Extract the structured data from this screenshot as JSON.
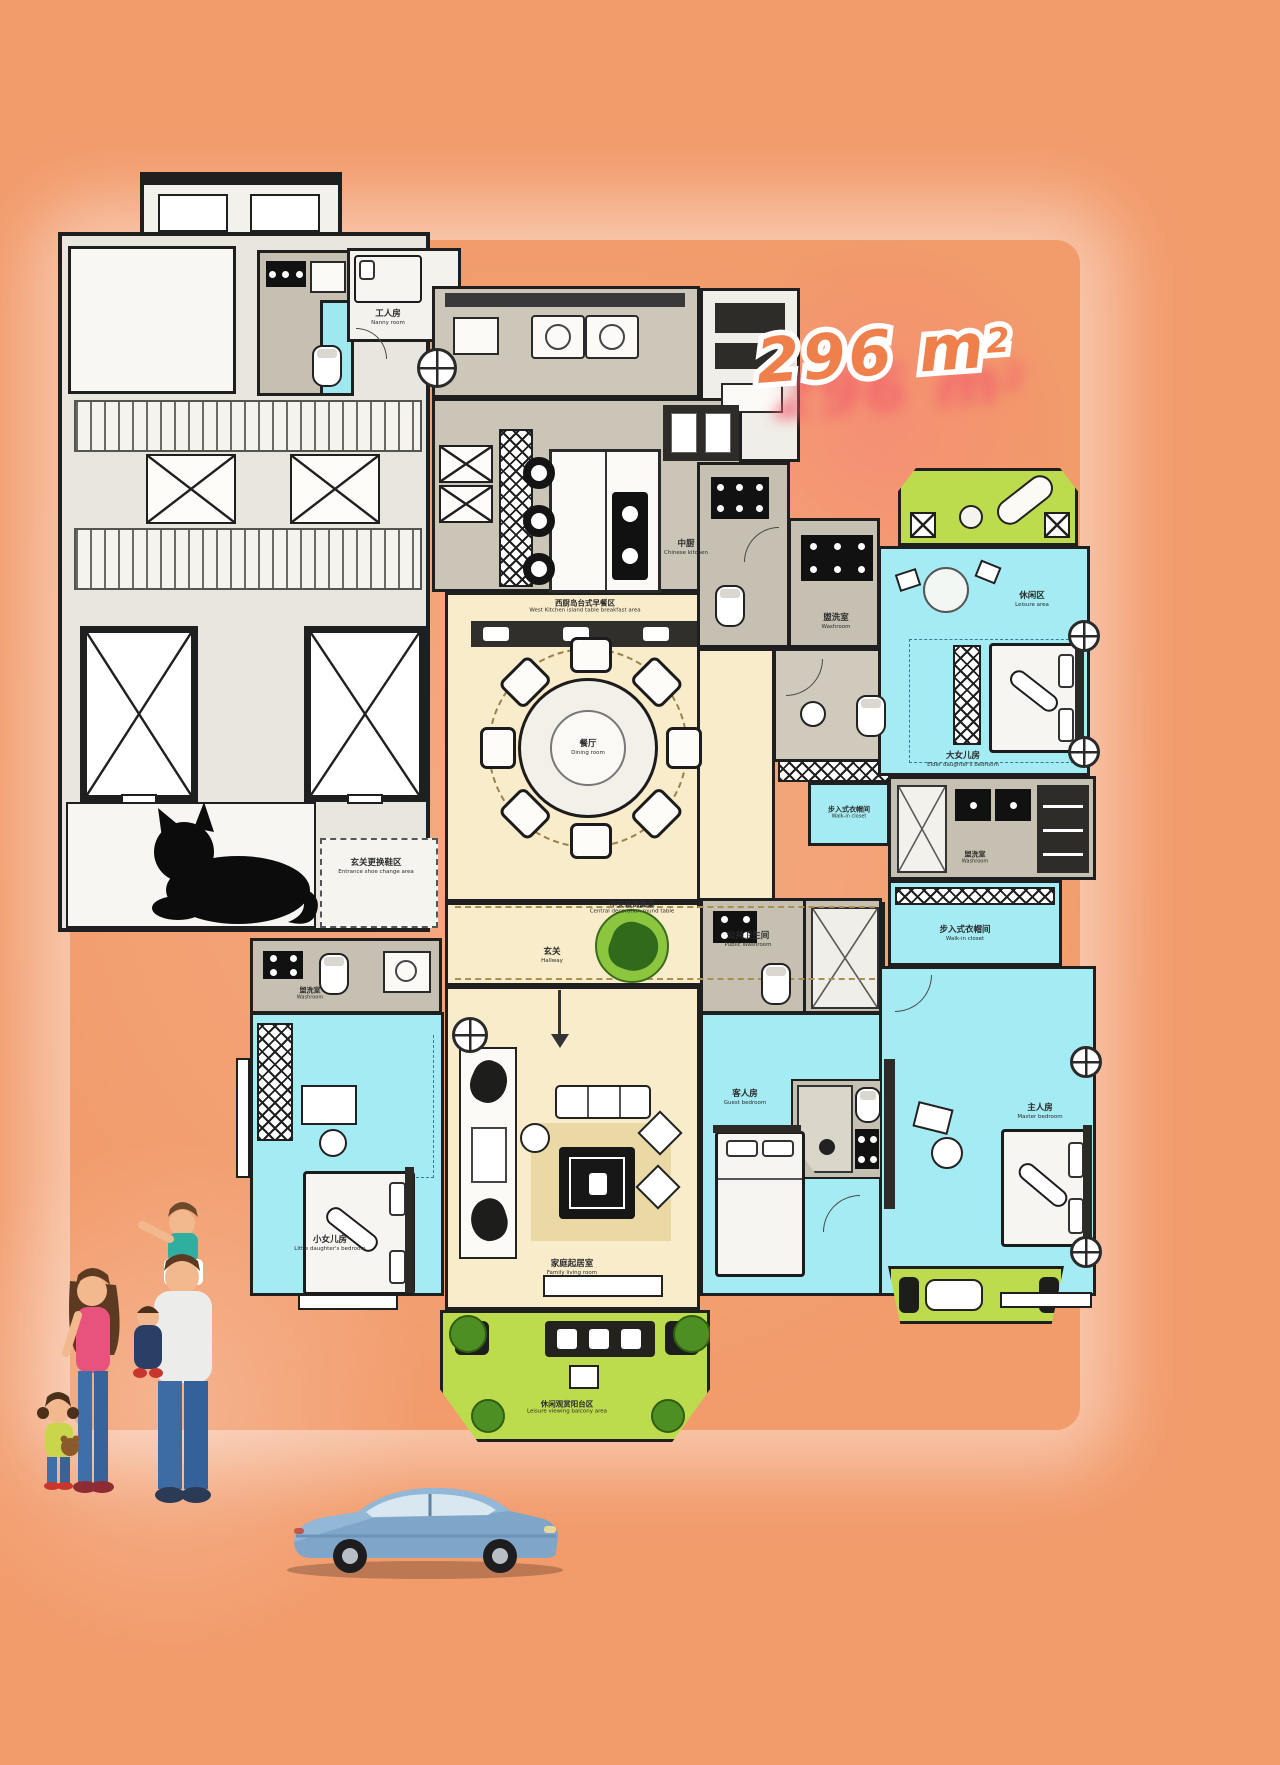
{
  "area_badge": {
    "value": "296 m",
    "superscript": "2"
  },
  "rooms": {
    "nanny_room": {
      "zh": "工人房",
      "en": "Nanny room"
    },
    "chinese_kitchen": {
      "zh": "中厨",
      "en": "Chinese kitchen"
    },
    "breakfast_area": {
      "zh": "西厨岛台式早餐区",
      "en": "West Kitchen island table breakfast area"
    },
    "dining_room": {
      "zh": "餐厅",
      "en": "Dining room"
    },
    "central_table": {
      "zh": "中央装饰圆桌",
      "en": "Central decoration round table"
    },
    "hallway": {
      "zh": "玄关",
      "en": "Hallway"
    },
    "entrance_shoe_area": {
      "zh": "玄关更换鞋区",
      "en": "Entrance shoe change area"
    },
    "leisure_area": {
      "zh": "休闲区",
      "en": "Leisure area"
    },
    "elder_daughter_bedroom": {
      "zh": "大女儿房",
      "en": "Elder daughter's bedroom"
    },
    "washroom_top": {
      "zh": "盥洗室",
      "en": "Washroom"
    },
    "washroom_master": {
      "zh": "盥洗室",
      "en": "Washroom"
    },
    "washroom_little": {
      "zh": "盥洗室",
      "en": "Washroom"
    },
    "public_washroom": {
      "zh": "公共卫生间",
      "en": "Public Washroom"
    },
    "walk_in_closet_1": {
      "zh": "步入式衣帽间",
      "en": "Walk-in closet"
    },
    "walk_in_closet_2": {
      "zh": "步入式衣帽间",
      "en": "Walk-in closet"
    },
    "master_bedroom": {
      "zh": "主人房",
      "en": "Master bedroom"
    },
    "guest_bedroom": {
      "zh": "客人房",
      "en": "Guest bedroom"
    },
    "little_daughter_bedroom": {
      "zh": "小女儿房",
      "en": "Little daughter's bedroom"
    },
    "family_living_room": {
      "zh": "家庭起居室",
      "en": "Family living room"
    },
    "leisure_balcony": {
      "zh": "休闲观赏阳台区",
      "en": "Leisure viewing balcony area"
    }
  },
  "decorations": {
    "cat": "black-cat-silhouette",
    "family": "family-of-four-illustration",
    "car": "blue-sedan-illustration"
  },
  "colors": {
    "background": "#F29B6B",
    "bedroom": "#A4EBF3",
    "living_area": "#F8ECCB",
    "balcony": "#BCDC4E",
    "bathroom": "#C5C0B1",
    "wall": "#1F1F1F",
    "area_text": "#EF7F4B",
    "area_shadow": "#F25F6D"
  }
}
